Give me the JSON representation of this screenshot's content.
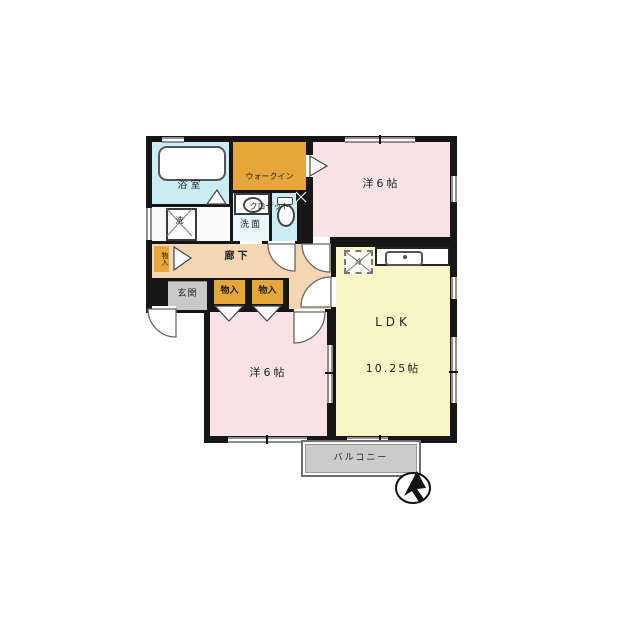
{
  "colors": {
    "wall": "#161616",
    "room_pink": "#f9e3e7",
    "room_yellow": "#f9f6c5",
    "bath_blue": "#cbecf3",
    "washroom_blue": "#e9f7fa",
    "closet_orange": "#e6a63c",
    "corridor_peach": "#f5d6b4",
    "entry_gray": "#c9c9c9",
    "balcony_gray": "#cbcbcb",
    "window_line": "#8f8f8f",
    "utility_white": "#fafafa"
  },
  "rooms": {
    "bathroom": {
      "label": "浴室"
    },
    "walk_in_closet": {
      "line1": "ウォークイン",
      "line2": "クロゼット"
    },
    "washroom": {
      "label": "洗面"
    },
    "washing_machine": {
      "label": "洗"
    },
    "toilet": {
      "label": ""
    },
    "corridor": {
      "label": "廊下"
    },
    "storage_side": {
      "label": "物入"
    },
    "entrance": {
      "label": "玄関"
    },
    "storage_a": {
      "label": "物入"
    },
    "storage_b": {
      "label": "物入"
    },
    "bedroom_upper": {
      "label": "洋6帖"
    },
    "bedroom_lower": {
      "label": "洋6帖"
    },
    "ldk": {
      "line1": "LDK",
      "line2": "10.25帖"
    },
    "refrigerator": {
      "label": "冷"
    },
    "balcony": {
      "label": "バルコニー"
    }
  },
  "icons": {
    "north_arrow": "north-arrow"
  }
}
